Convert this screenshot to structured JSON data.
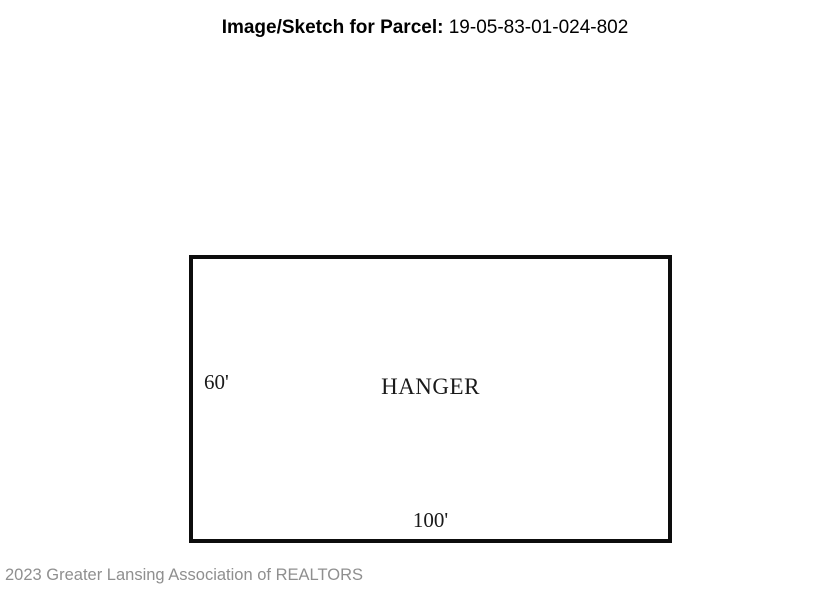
{
  "header": {
    "title_label": "Image/Sketch for Parcel:",
    "title_value": "19-05-83-01-024-802"
  },
  "sketch": {
    "building_label": "HANGER",
    "left_dimension": "60'",
    "bottom_dimension": "100'"
  },
  "footer": {
    "copyright": "2023 Greater Lansing Association of REALTORS"
  },
  "colors": {
    "background": "#ffffff",
    "outline": "#0d0d0d",
    "title_text": "#000000",
    "sketch_text": "#1a1a1a",
    "footer_text": "#8f8f8f"
  }
}
